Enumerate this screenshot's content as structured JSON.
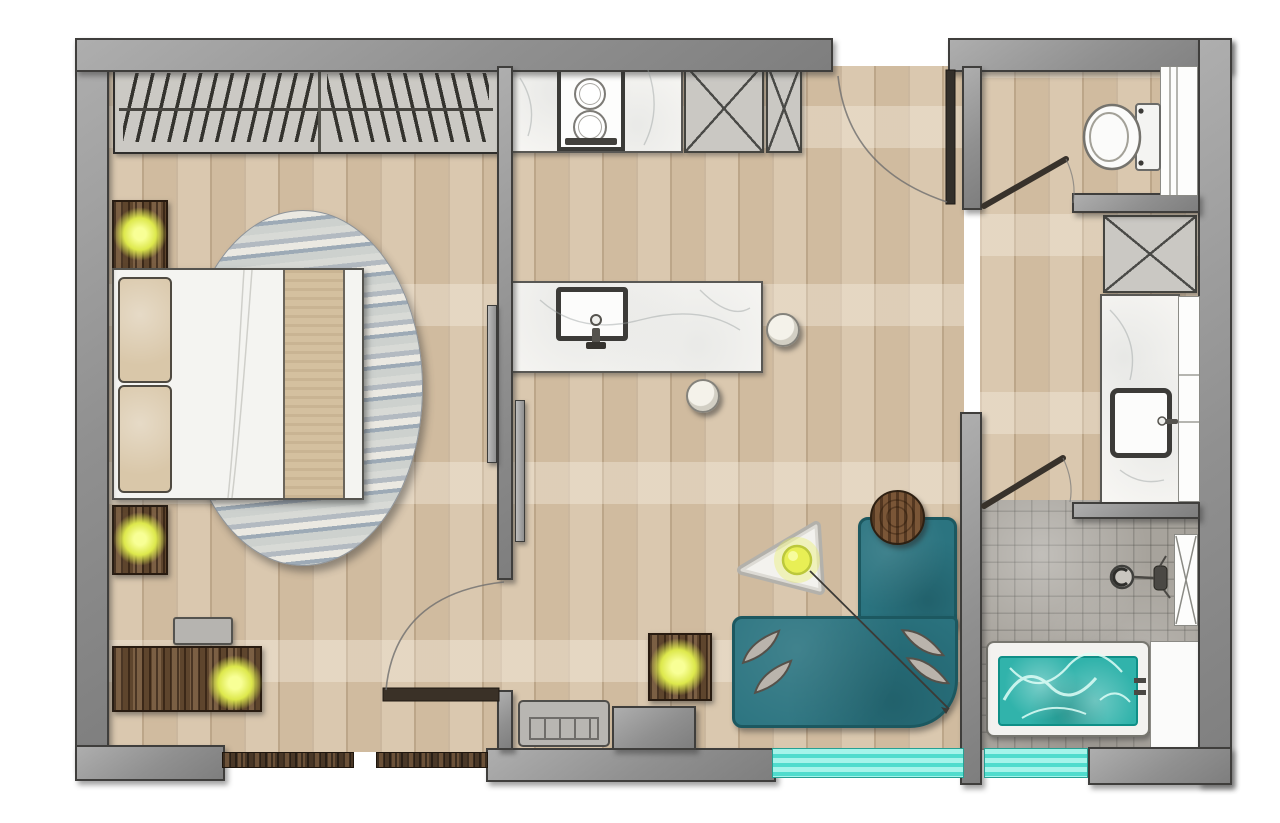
{
  "title": "apartment-floor-plan",
  "colors": {
    "wall": "#9a9a9a",
    "wall_outline": "#3f3e3c",
    "floor_wood": "#d0bb9f",
    "floor_wood_light": "#e6d9c2",
    "shower_tile": "#a7a39c",
    "marble": "#f7f6f3",
    "sofa_teal": "#2b7480",
    "tub_water": "#31b3ab",
    "window_glass": "#4fdccd",
    "lamp_glow": "#dde84c",
    "dark_wood": "#5e452d",
    "rug_gray": "#bfc2c4",
    "pillow_beige": "#d9c7a9"
  },
  "labels": {
    "plan": "Apartment floor plan",
    "bedroom_floor": "Bedroom wood floor",
    "living_floor": "Living room and kitchen wood floor",
    "bath_floor": "Bathroom wood floor",
    "shower_floor": "Shower tiled floor",
    "wardrobe": "Wardrobe with hangers",
    "bed": "Double bed",
    "pillow": "Pillow",
    "throw": "Bed runner",
    "rug": "Oval area rug",
    "nightstand": "Nightstand with lamp",
    "dresser": "Dresser with lamp",
    "bench": "Bench",
    "bedroom_door": "Bedroom door",
    "sliding_door": "Sliding door panel",
    "kitchen_counter": "Kitchen counter",
    "cooktop": "Cooktop with two burners",
    "tall_cabinet": "Tall cabinet",
    "island": "Kitchen island",
    "island_sink": "Island sink",
    "bar_stool": "Bar stool",
    "entry_door": "Entrance door",
    "sofa_seat": "Corner sofa",
    "sofa_chaise": "Sofa chaise",
    "coffee_table": "Coffee table with lamp",
    "side_table": "Side table with lamp",
    "round_table": "Round side table",
    "floor_lamp": "Arc floor lamp",
    "radiator": "Radiator cabinet",
    "window": "Window",
    "toilet": "Toilet",
    "bath_cabinet": "Bathroom cabinet",
    "vanity": "Vanity counter",
    "vanity_sink": "Vanity sink",
    "shower": "Shower area",
    "drain": "Shower drain",
    "shower_head": "Shower head",
    "bathtub": "Bathtub",
    "bath_door": "Shower room door",
    "wc_door": "WC door"
  }
}
